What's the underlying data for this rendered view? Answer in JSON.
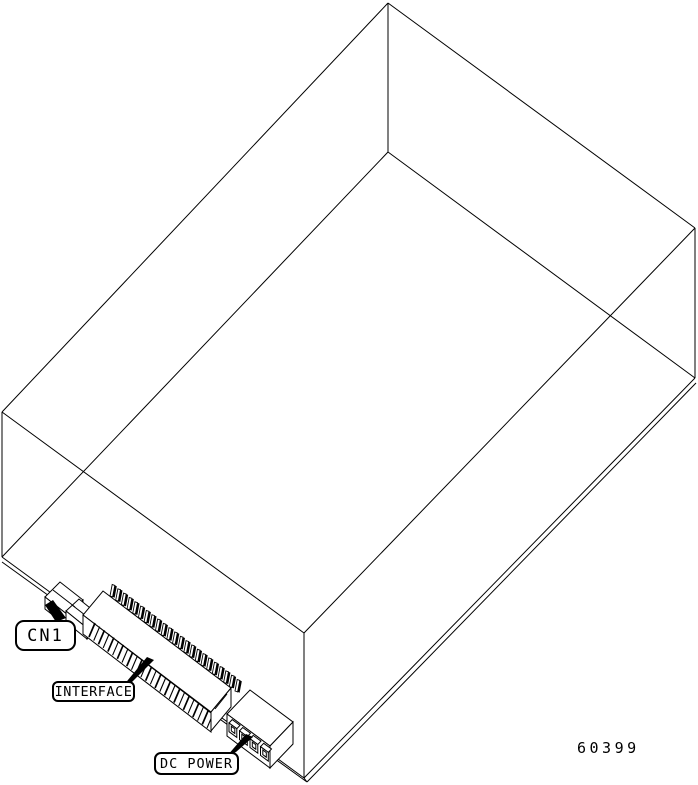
{
  "diagram": {
    "labels": {
      "cn1": "CN1",
      "interface": "INTERFACE",
      "dc_power": "DC POWER"
    },
    "part_number": "60399",
    "colors": {
      "line": "#000000",
      "background": "#ffffff"
    }
  }
}
